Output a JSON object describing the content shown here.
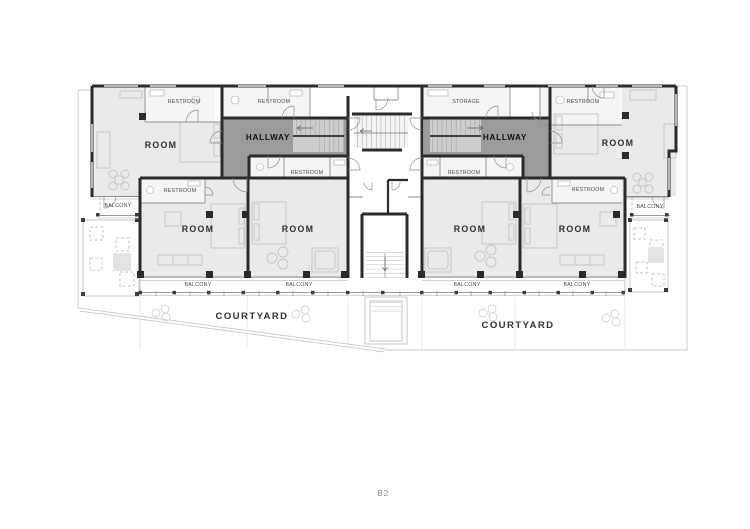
{
  "plan": {
    "floor_label": "B2",
    "labels": {
      "room": "ROOM",
      "restroom": "RESTROOM",
      "hallway": "HALLWAY",
      "balcony": "BALCONY",
      "storage": "STORAGE",
      "courtyard": "COURTYARD"
    },
    "label_instances": {
      "room": 6,
      "restroom": 7,
      "hallway": 2,
      "balcony": 6,
      "storage": 1,
      "courtyard": 2
    },
    "colors": {
      "wall": "#2b2b2b",
      "hallway_fill": "#9b9b9b",
      "room_fill": "#eaeaea",
      "restroom_fill": "#f5f5f5",
      "partition": "#8f8f8f",
      "furniture": "#c4c4c4",
      "site_line": "#cccccc",
      "label_text": "#4c4c4c",
      "floor_label_text": "#909090"
    }
  }
}
